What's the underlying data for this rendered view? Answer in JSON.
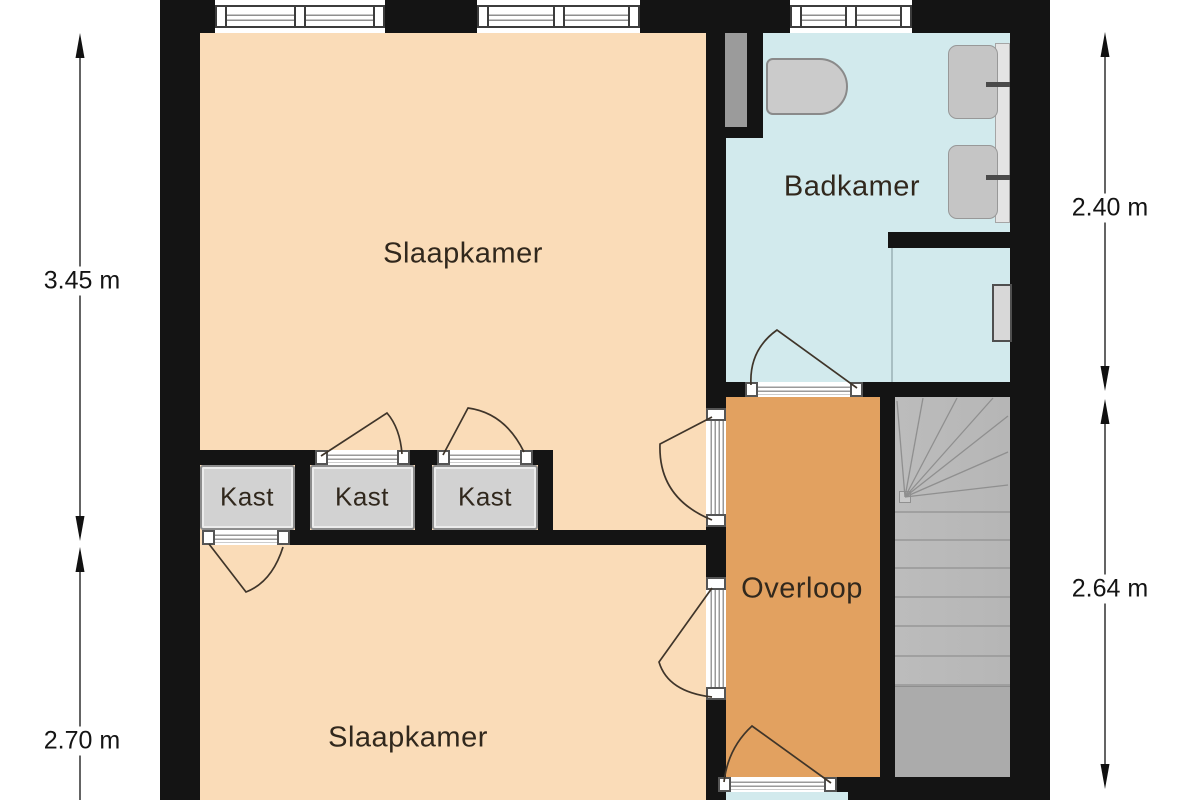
{
  "rooms": {
    "bedroom_top": {
      "label": "Slaapkamer"
    },
    "bedroom_bottom": {
      "label": "Slaapkamer"
    },
    "bathroom": {
      "label": "Badkamer"
    },
    "landing": {
      "label": "Overloop"
    },
    "closet_1": {
      "label": "Kast"
    },
    "closet_2": {
      "label": "Kast"
    },
    "closet_3": {
      "label": "Kast"
    }
  },
  "dimensions": {
    "left_upper": {
      "value": "3.45 m"
    },
    "left_lower": {
      "value": "2.70 m"
    },
    "right_upper": {
      "value": "2.40 m"
    },
    "right_lower": {
      "value": "2.64 m"
    }
  },
  "colors": {
    "wall": "#141414",
    "bedroom_fill": "#fadcb8",
    "bathroom_fill": "#d2eaed",
    "landing_fill": "#e2a160",
    "closet_fill": "#d2d2d2",
    "stairs_fill": "#b6b6b6"
  }
}
